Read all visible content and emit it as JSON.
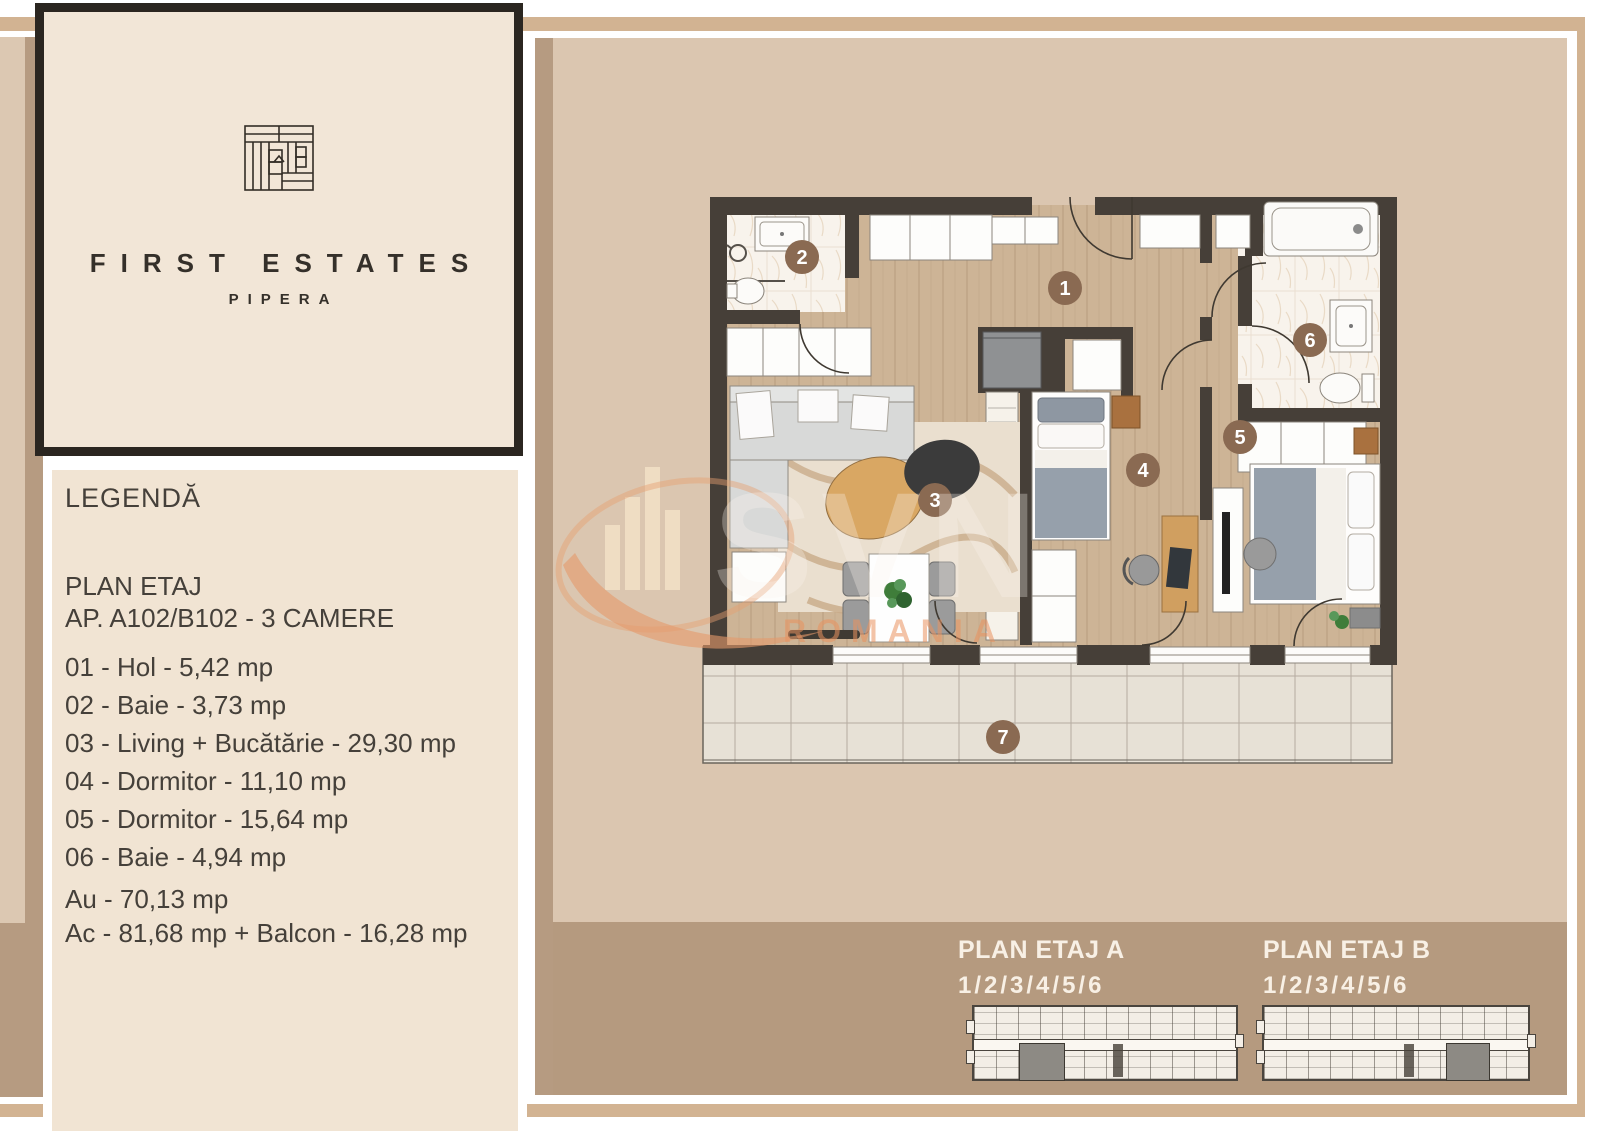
{
  "logo": {
    "brand": "FIRST ESTATES",
    "location": "PIPERA"
  },
  "legend": {
    "title": "LEGENDĂ",
    "plan_line1": "PLAN ETAJ",
    "plan_line2": "AP. A102/B102 - 3 CAMERE",
    "rooms": [
      "01 - Hol - 5,42 mp",
      "02 - Baie - 3,73 mp",
      "03 - Living + Bucătărie - 29,30 mp",
      "04 - Dormitor - 11,10 mp",
      "05 - Dormitor - 15,64 mp",
      "06 - Baie - 4,94 mp"
    ],
    "area_useful": "Au - 70,13 mp",
    "area_built": "Ac - 81,68 mp + Balcon - 16,28 mp"
  },
  "floor_plan": {
    "room_labels": [
      "1",
      "2",
      "3",
      "4",
      "5",
      "6",
      "7"
    ],
    "watermark_brand": "SVN",
    "watermark_country": "ROMANIA"
  },
  "footer_plans": [
    {
      "title": "PLAN ETAJ A",
      "levels": "1/2/3/4/5/6"
    },
    {
      "title": "PLAN ETAJ B",
      "levels": "1/2/3/4/5/6"
    }
  ],
  "colors": {
    "frame_tan": "#d2b392",
    "left_strip_light": "#dcc8b2",
    "left_strip_dark": "#b69b81",
    "panel_beige": "#dbc6b0",
    "panel_bottom": "#b59a7f",
    "legend_bg": "#f1e4d3",
    "logo_bg": "#f2e6d7",
    "logo_border": "#2b2620",
    "text": "#45403a",
    "wall": "#463f38",
    "wood_floor": "#cdb496",
    "marble": "#f8f3ec",
    "balcony_tile": "#e7e1d6",
    "number_circle": "#8a6a52",
    "watermark_orange": "#e89a6e",
    "footer_text": "#f8f0e5"
  }
}
